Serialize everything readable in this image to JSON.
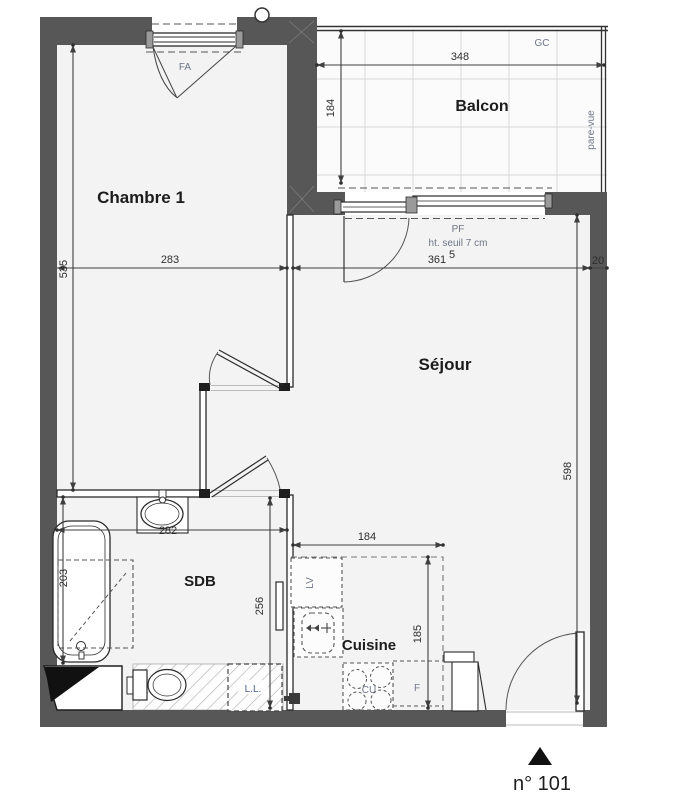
{
  "plan": {
    "unit_number": "n° 101",
    "rooms": [
      {
        "id": "chambre1",
        "label": "Chambre 1"
      },
      {
        "id": "sejour",
        "label": "Séjour"
      },
      {
        "id": "balcon",
        "label": "Balcon"
      },
      {
        "id": "sdb",
        "label": "SDB"
      },
      {
        "id": "cuisine",
        "label": "Cuisine"
      }
    ],
    "annotations": {
      "fa": "FA",
      "gc": "GC",
      "pare_vue": "pare-vue",
      "pf": "PF",
      "pf_note": "ht. seuil  7 cm",
      "lv": "LV",
      "cu": "CU",
      "f": "F",
      "ll": "L.L."
    },
    "dimensions": {
      "d535": "535",
      "d283": "283",
      "d361": "361",
      "d361_sup": "5",
      "d20": "20",
      "d348": "348",
      "d184_balcon": "184",
      "d598": "598",
      "d282": "282",
      "d203": "203",
      "d256": "256",
      "d184_cuisine": "184",
      "d185": "185"
    },
    "colors": {
      "wall": "#575757",
      "room_fill": "#f3f3f3",
      "balcony_fill": "#fbfbfb",
      "line": "#2b2b2b",
      "dim_line": "#3f3f3f",
      "muted_label": "#6e7787",
      "ll_label": "#4a618f"
    }
  }
}
